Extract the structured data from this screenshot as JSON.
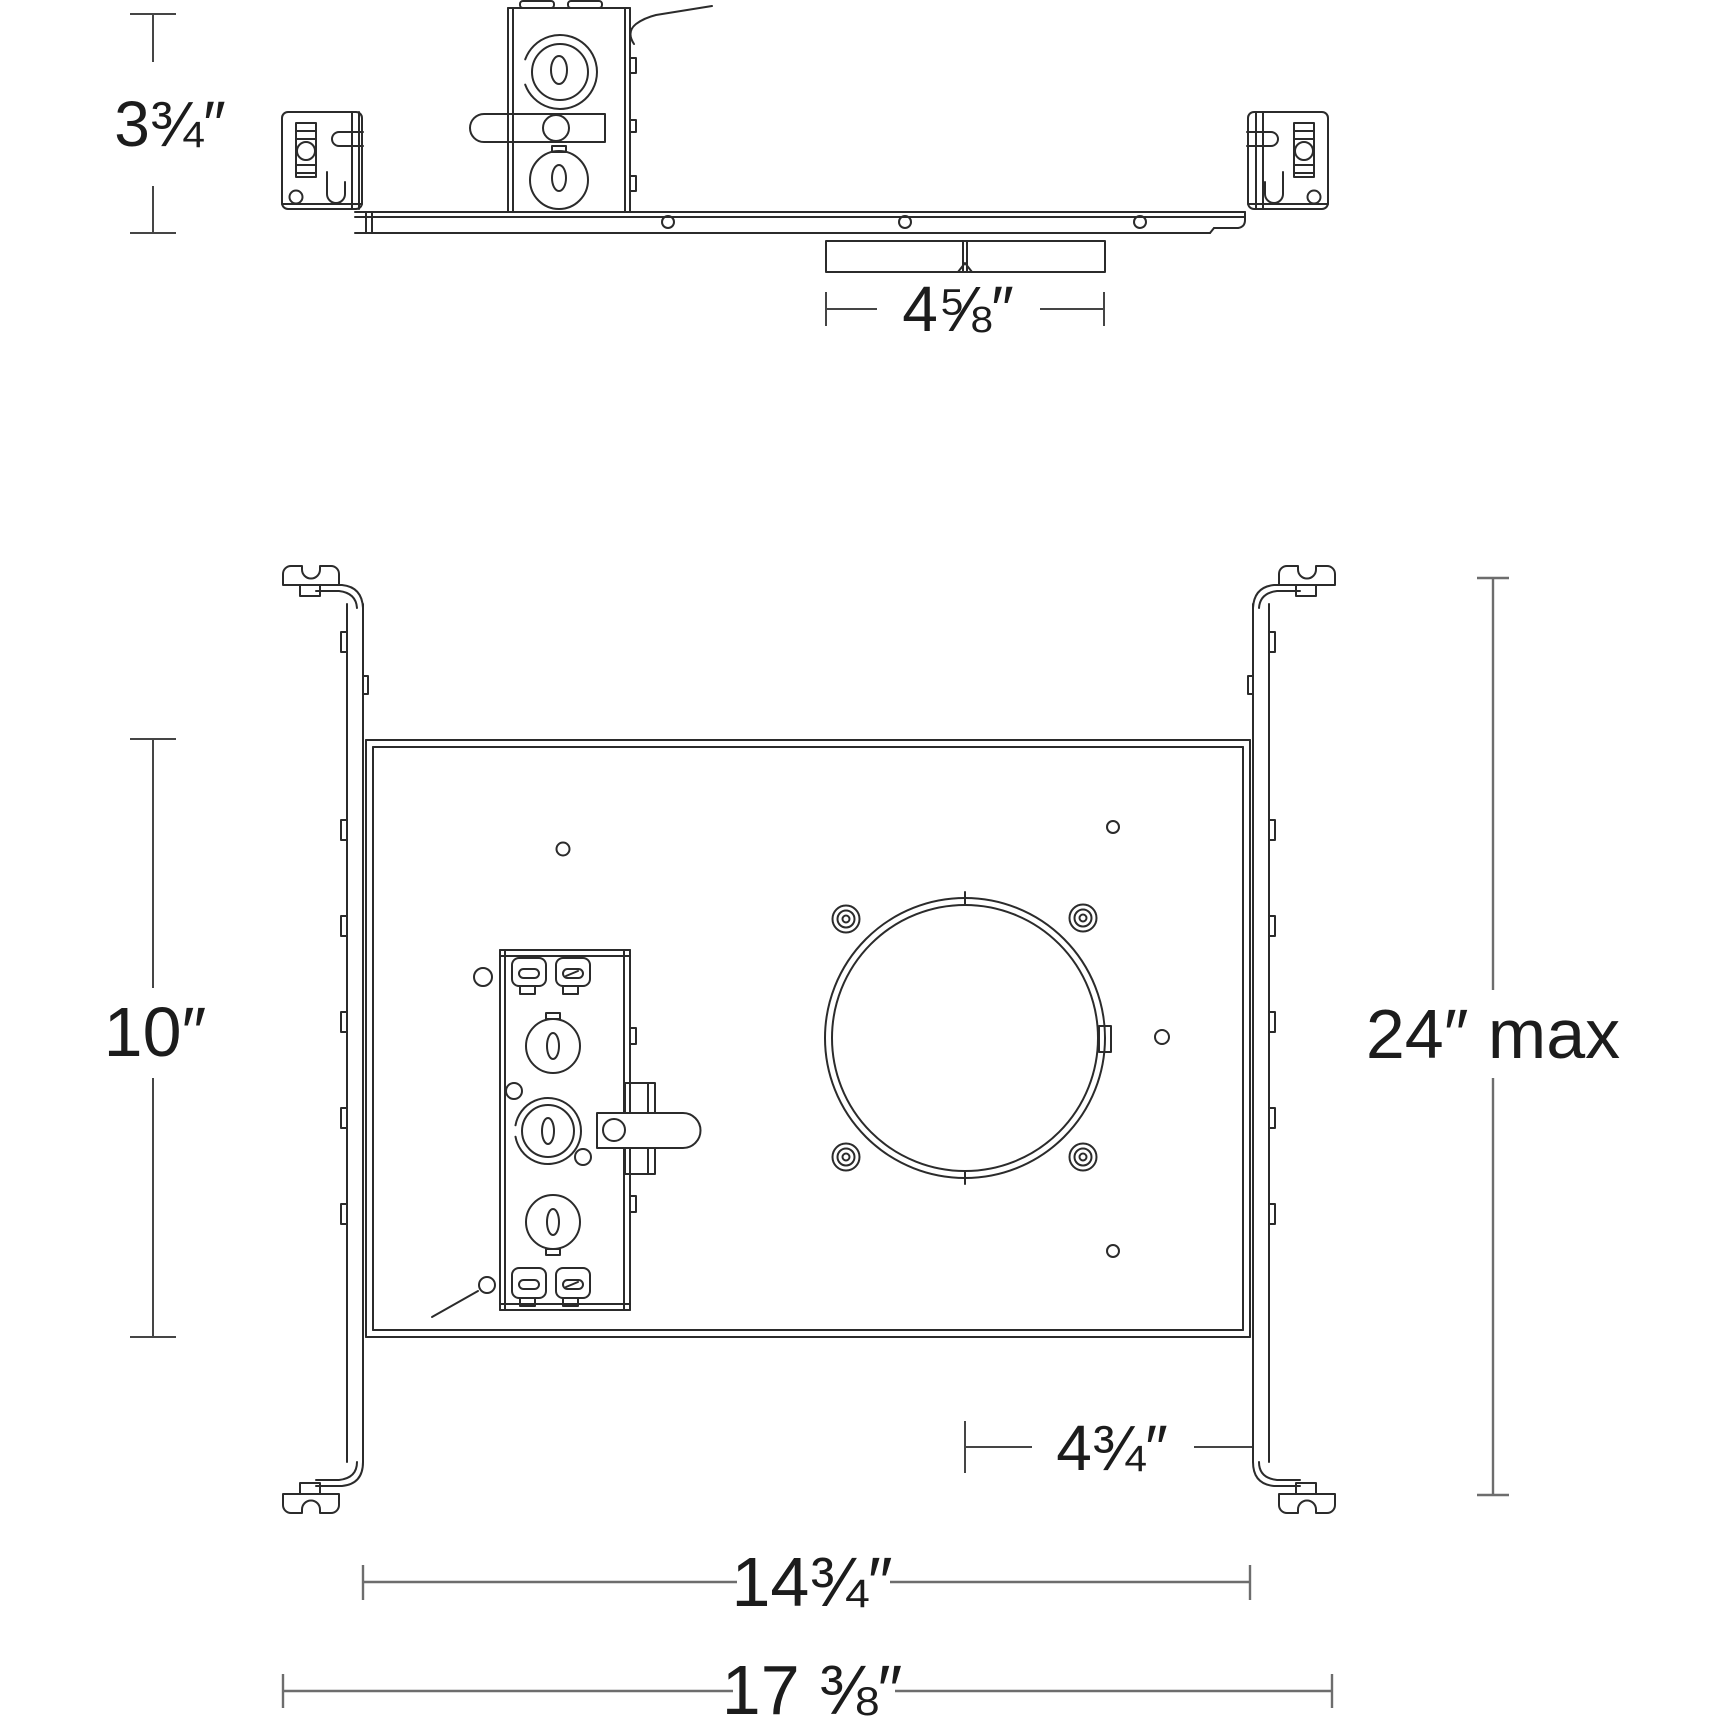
{
  "drawing": {
    "type": "technical-dimension-drawing",
    "views": {
      "side_view": "recessed housing frame side elevation",
      "plan_view": "recessed housing mounting frame plan"
    }
  },
  "dimensions": {
    "housing_height": "3¾″",
    "driver_width": "4⅝″",
    "plate_height": "10″",
    "hanger_bar_max": "24″ max",
    "hole_center_offset": "4¾″",
    "plate_width": "14¾″",
    "overall_width": "17 ⅜″"
  },
  "colors": {
    "line": "#2b2b2b",
    "dimension_line": "#454545",
    "dimension_line_light": "#6d6d6d",
    "background": "#ffffff"
  }
}
